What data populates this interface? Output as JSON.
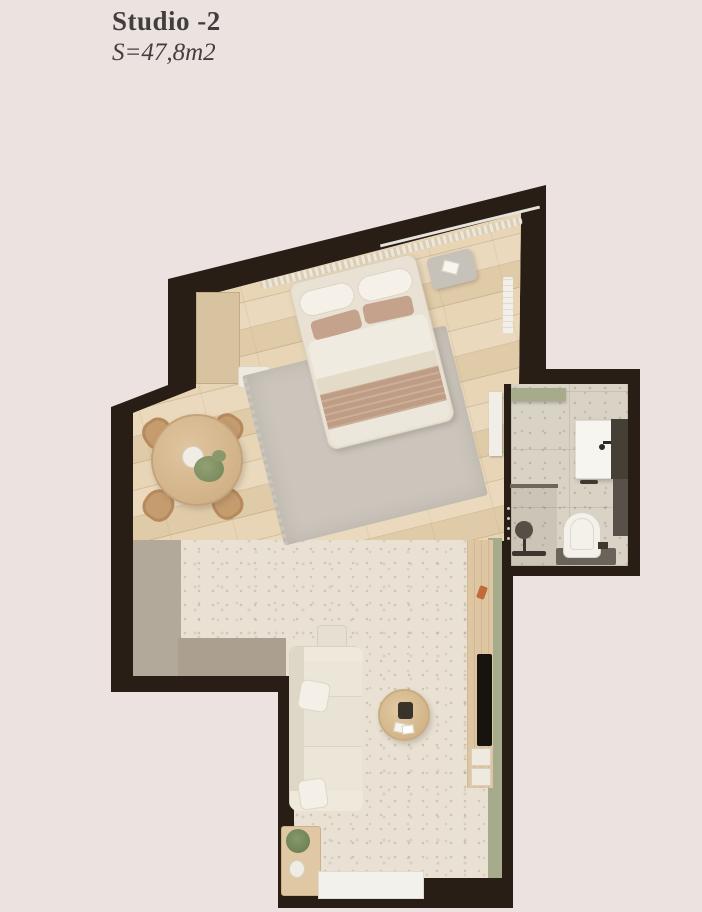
{
  "header": {
    "title": "Studio -2",
    "area": "S=47,8m2"
  },
  "palette": {
    "background": "#ece3e1",
    "wall": "#281e16",
    "wood": "#e6d3b4",
    "stone": "#e9e2d4",
    "bath": "#d9d3c6",
    "green": "#a6ac8b",
    "gray_a": "#b3a99b",
    "gray_b": "#ab9f90",
    "rug": "#cbc5bc"
  },
  "elements": [
    "exterior-walls",
    "wood-floor",
    "terrazzo-floor",
    "bathroom-floor",
    "window",
    "curtain",
    "wardrobe",
    "radiator",
    "double-bed",
    "area-rug",
    "ottoman",
    "dining-table",
    "dining-chairs",
    "sofa",
    "coffee-table",
    "tv-panel",
    "tv",
    "side-table",
    "plant",
    "entry-mat",
    "bathroom-door",
    "washbasin",
    "toilet",
    "shower-head",
    "shower-partition",
    "green-shelf"
  ]
}
